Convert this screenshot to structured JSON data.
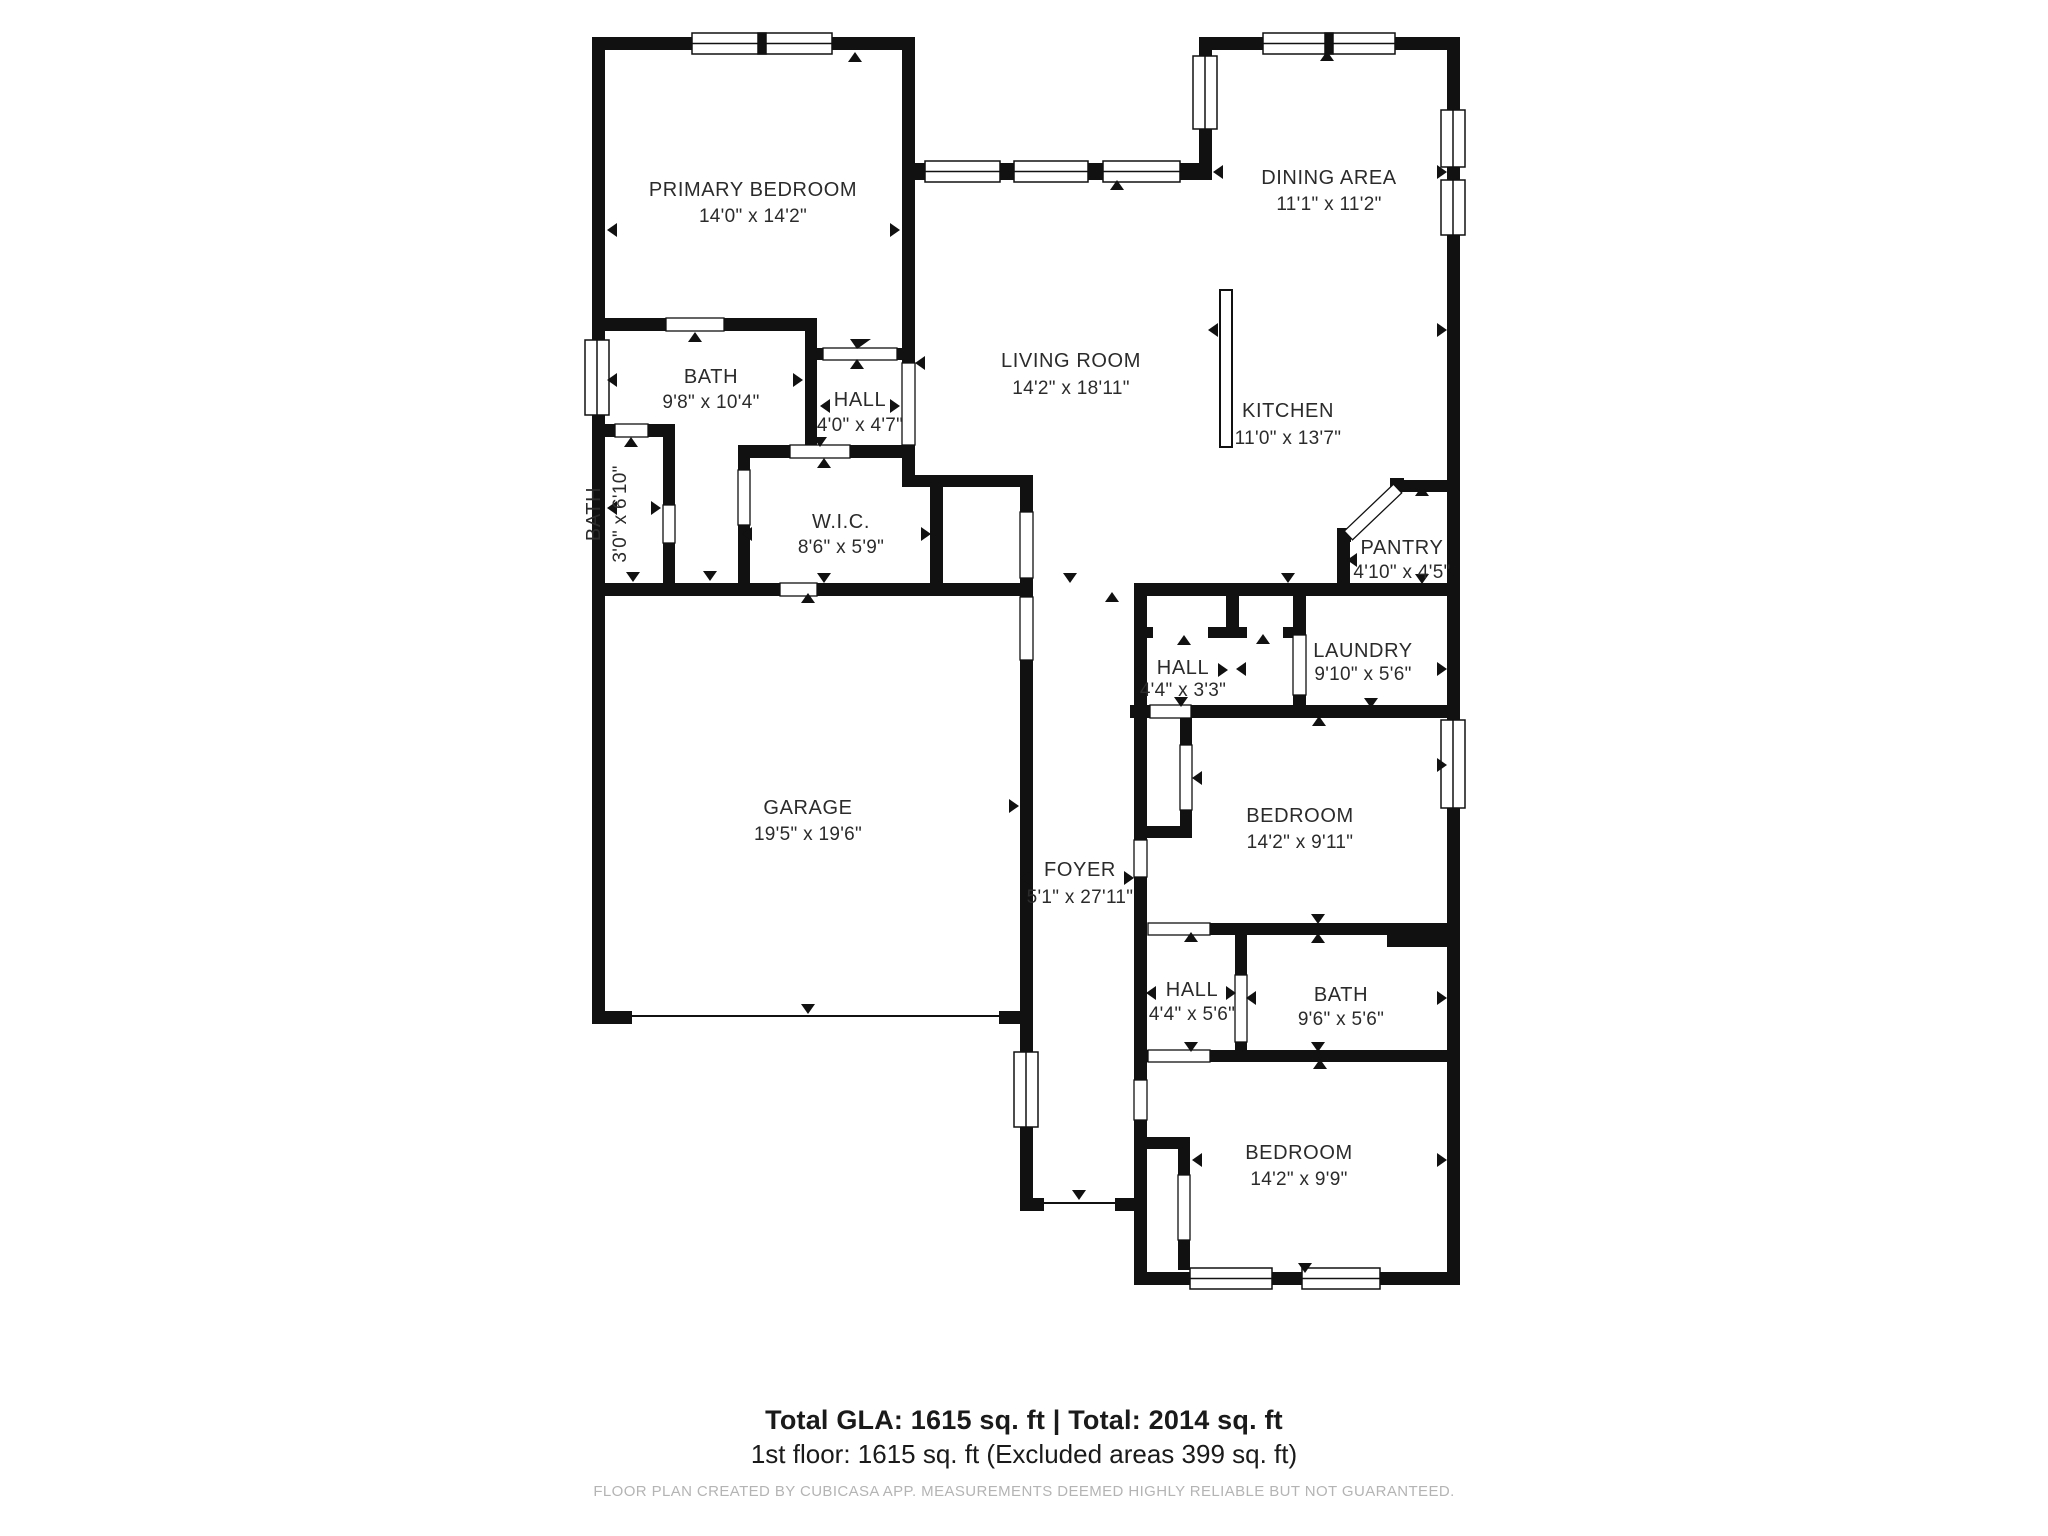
{
  "meta": {
    "app": "CubiCasa floor plan",
    "background_color": "#ffffff",
    "wall_color": "#111111",
    "label_color": "#2b2b2b",
    "caption_color": "#b4b4b4"
  },
  "rooms": [
    {
      "id": "primary-bedroom",
      "name": "PRIMARY BEDROOM",
      "dims": "14'0\" x 14'2\""
    },
    {
      "id": "bath-main",
      "name": "BATH",
      "dims": "9'8\" x 10'4\""
    },
    {
      "id": "hall-upper",
      "name": "HALL",
      "dims": "4'0\" x 4'7\""
    },
    {
      "id": "bath-small",
      "name": "BATH",
      "dims": "3'0\" x 6'10\""
    },
    {
      "id": "wic",
      "name": "W.I.C.",
      "dims": "8'6\" x 5'9\""
    },
    {
      "id": "living-room",
      "name": "LIVING ROOM",
      "dims": "14'2\" x 18'11\""
    },
    {
      "id": "dining-area",
      "name": "DINING AREA",
      "dims": "11'1\" x 11'2\""
    },
    {
      "id": "kitchen",
      "name": "KITCHEN",
      "dims": "11'0\" x 13'7\""
    },
    {
      "id": "pantry",
      "name": "PANTRY",
      "dims": "4'10\" x 4'5\""
    },
    {
      "id": "laundry",
      "name": "LAUNDRY",
      "dims": "9'10\" x 5'6\""
    },
    {
      "id": "hall-middle",
      "name": "HALL",
      "dims": "4'4\" x 3'3\""
    },
    {
      "id": "garage",
      "name": "GARAGE",
      "dims": "19'5\" x 19'6\""
    },
    {
      "id": "foyer",
      "name": "FOYER",
      "dims": "5'1\" x 27'11\""
    },
    {
      "id": "bedroom-2",
      "name": "BEDROOM",
      "dims": "14'2\" x 9'11\""
    },
    {
      "id": "hall-lower",
      "name": "HALL",
      "dims": "4'4\" x 5'6\""
    },
    {
      "id": "bath-2",
      "name": "BATH",
      "dims": "9'6\" x 5'6\""
    },
    {
      "id": "bedroom-3",
      "name": "BEDROOM",
      "dims": "14'2\" x 9'9\""
    }
  ],
  "summary": {
    "line1": "Total GLA: 1615 sq. ft | Total: 2014 sq. ft",
    "line2": "1st floor: 1615 sq. ft (Excluded areas 399 sq. ft)"
  },
  "footer": {
    "caption": "FLOOR PLAN CREATED BY CUBICASA APP. MEASUREMENTS DEEMED HIGHLY RELIABLE BUT NOT GUARANTEED."
  }
}
